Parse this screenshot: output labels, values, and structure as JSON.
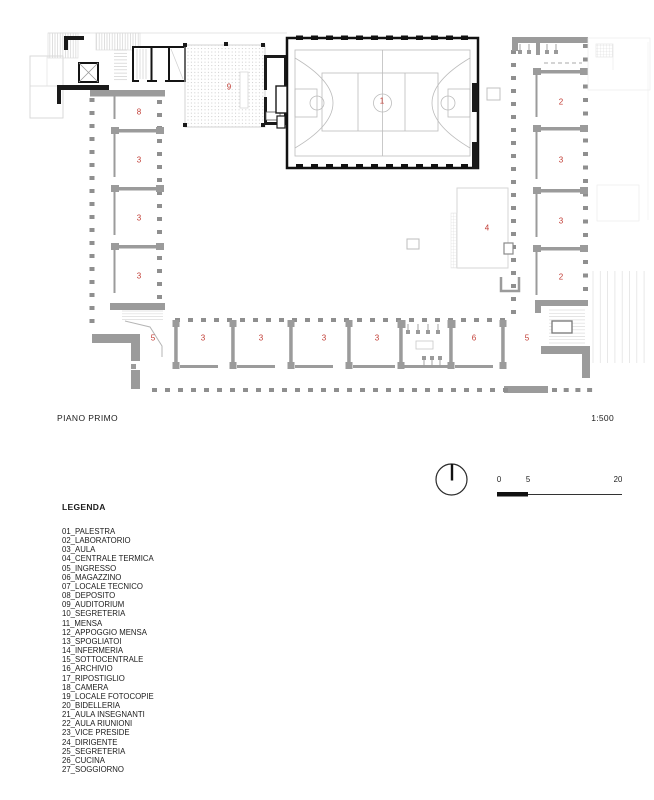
{
  "page": {
    "title": "PIANO PRIMO",
    "scale": "1:500"
  },
  "legend": {
    "title": "LEGENDA",
    "items": [
      "01_PALESTRA",
      "02_LABORATORIO",
      "03_AULA",
      "04_CENTRALE TERMICA",
      "05_INGRESSO",
      "06_MAGAZZINO",
      "07_LOCALE TECNICO",
      "08_DEPOSITO",
      "09_AUDITORIUM",
      "10_SEGRETERIA",
      "11_MENSA",
      "12_APPOGGIO MENSA",
      "13_SPOGLIATOI",
      "14_INFERMERIA",
      "15_SOTTOCENTRALE",
      "16_ARCHIVIO",
      "17_RIPOSTIGLIO",
      "18_CAMERA",
      "19_LOCALE FOTOCOPIE",
      "20_BIDELLERIA",
      "21_AULA INSEGNANTI",
      "22_AULA RIUNIONI",
      "23_VICE PRESIDE",
      "24_DIRIGENTE",
      "25_SEGRETERIA",
      "26_CUCINA",
      "27_SOGGIORNO"
    ]
  },
  "plan": {
    "label_color": "#c13b33",
    "wall_gray": "#9b9b9b",
    "wall_black": "#1a1a1a",
    "room_labels": [
      {
        "n": "9",
        "x": 229,
        "y": 87
      },
      {
        "n": "1",
        "x": 382,
        "y": 101
      },
      {
        "n": "8",
        "x": 139,
        "y": 112
      },
      {
        "n": "3",
        "x": 139,
        "y": 160
      },
      {
        "n": "3",
        "x": 139,
        "y": 218
      },
      {
        "n": "3",
        "x": 139,
        "y": 276
      },
      {
        "n": "2",
        "x": 561,
        "y": 102
      },
      {
        "n": "3",
        "x": 561,
        "y": 160
      },
      {
        "n": "3",
        "x": 561,
        "y": 221
      },
      {
        "n": "2",
        "x": 561,
        "y": 277
      },
      {
        "n": "4",
        "x": 487,
        "y": 228
      },
      {
        "n": "5",
        "x": 153,
        "y": 338
      },
      {
        "n": "3",
        "x": 203,
        "y": 338
      },
      {
        "n": "3",
        "x": 261,
        "y": 338
      },
      {
        "n": "3",
        "x": 324,
        "y": 338
      },
      {
        "n": "3",
        "x": 377,
        "y": 338
      },
      {
        "n": "6",
        "x": 474,
        "y": 338
      },
      {
        "n": "5",
        "x": 527,
        "y": 338
      }
    ]
  },
  "scale_bar": {
    "labels": [
      {
        "t": "0",
        "x": 499
      },
      {
        "t": "5",
        "x": 528
      },
      {
        "t": "20",
        "x": 618
      }
    ]
  }
}
